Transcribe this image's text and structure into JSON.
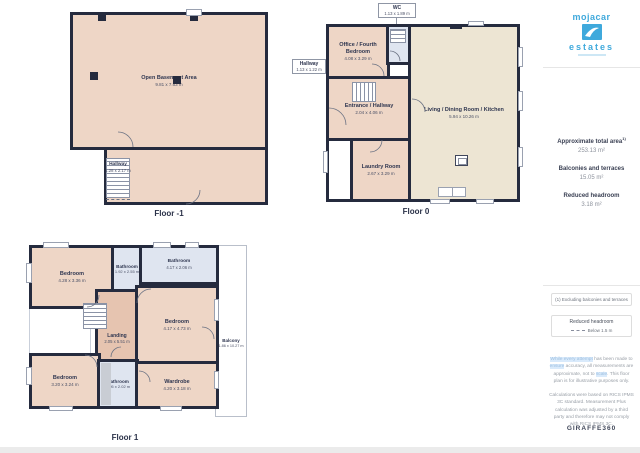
{
  "branding": {
    "agency_top": "mojacar",
    "agency_bottom": "estates",
    "brand_color": "#3fa9dc",
    "provider": "GIRAFFE360"
  },
  "sidebar": {
    "stats": [
      {
        "label": "Approximate total area",
        "sup": "1)",
        "value": "253.13 m²"
      },
      {
        "label": "Balconies and terraces",
        "sup": "",
        "value": "15.05 m²"
      },
      {
        "label": "Reduced headroom",
        "sup": "",
        "value": "3.18 m²"
      }
    ],
    "footnote": "(1) Excluding balconies and terraces",
    "legend": {
      "title": "Reduced headroom",
      "label": "Below 1.5 m"
    },
    "disclaimer1": [
      {
        "t": "While every attempt"
      },
      {
        "t": " has been made to "
      },
      {
        "t": "ensure"
      },
      {
        "t": " accuracy, all measurements are approximate, not to "
      },
      {
        "t": "scale"
      },
      {
        "t": ". This floor plan is for illustrative purposes only."
      }
    ],
    "disclaimer2": "Calculations were based on RICS IPMS 3C standard. Measurement Plus calculation was adjusted by a third party and therefore may not comply with RICS IPMS 3C."
  },
  "floors": [
    {
      "name": "Floor -1",
      "rooms": [
        {
          "label": "Open Basement Area",
          "dims": "9.81 x 7.63 m"
        },
        {
          "label": "Hallway",
          "dims": "1.28 x 2.17 m"
        }
      ]
    },
    {
      "name": "Floor 0",
      "rooms": [
        {
          "label": "WC",
          "dims": "1.13 x 1.89 m"
        },
        {
          "label": "Office / Fourth Bedroom",
          "dims": "4.08 x 3.29 m"
        },
        {
          "label": "Hallway",
          "dims": "1.13 x 1.22 m"
        },
        {
          "label": "Entrance / Hallway",
          "dims": "2.04 x 4.06 m"
        },
        {
          "label": "Living / Dining Room / Kitchen",
          "dims": "5.94 x 10.26 m"
        },
        {
          "label": "Laundry Room",
          "dims": "2.67 x 3.29 m"
        }
      ]
    },
    {
      "name": "Floor 1",
      "rooms": [
        {
          "label": "Bedroom",
          "dims": "4.28 x 3.36 m"
        },
        {
          "label": "Bathroom",
          "dims": "1.92 x 2.55 m"
        },
        {
          "label": "Bathroom",
          "dims": "4.17 x 2.06 m"
        },
        {
          "label": "Landing",
          "dims": "2.05 x 5.51 m"
        },
        {
          "label": "Bedroom",
          "dims": "4.17 x 4.73 m"
        },
        {
          "label": "Bedroom",
          "dims": "3.20 x 3.24 m"
        },
        {
          "label": "Bathroom",
          "dims": "2.05 x 2.02 m"
        },
        {
          "label": "Wardrobe",
          "dims": "4.20 x 3.18 m"
        },
        {
          "label": "Balcony",
          "dims": "1.86 x 10.27 m"
        }
      ]
    }
  ],
  "colors": {
    "wall": "#252b3e",
    "room_warm": "#eed6c6",
    "room_warm_dark": "#e6c4b0",
    "room_cream": "#ede5d3",
    "room_wet": "#dfe5f0"
  }
}
